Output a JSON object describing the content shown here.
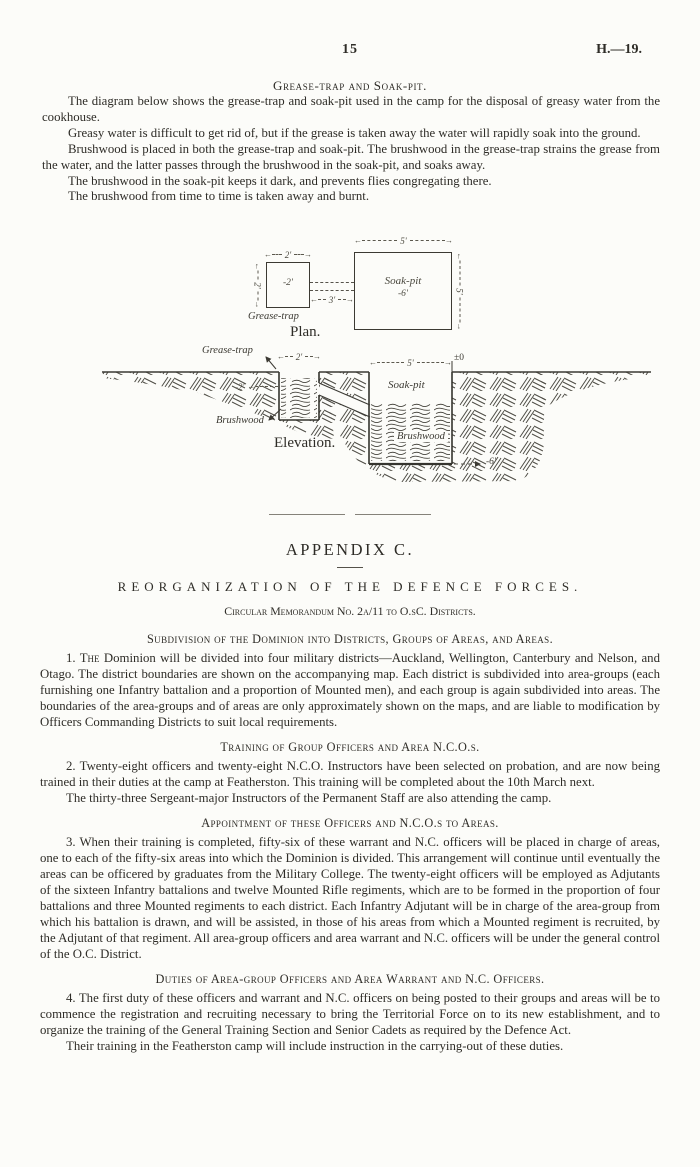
{
  "page": {
    "number": "15",
    "reference": "H.—19."
  },
  "grease_section": {
    "heading": "Grease-trap and Soak-pit.",
    "paragraphs": [
      "The diagram below shows the grease-trap and soak-pit used in the camp for the disposal of greasy water from the cookhouse.",
      "Greasy water is difficult to get rid of, but if the grease is taken away the water will rapidly soak into the ground.",
      "Brushwood is placed in both the grease-trap and soak-pit. The brushwood in the grease-trap strains the grease from the water, and the latter passes through the brushwood in the soak-pit, and soaks away.",
      "The brushwood in the soak-pit keeps it dark, and prevents flies congregating there.",
      "The brushwood from time to time is taken away and burnt."
    ]
  },
  "diagram": {
    "plan": {
      "caption": "Plan.",
      "grease_trap_label": "Grease-trap",
      "grease_trap_width": "2'",
      "grease_trap_side": "2'",
      "grease_trap_depth": "-2'",
      "channel_length": "3'",
      "soak_pit_label": "Soak-pit",
      "soak_pit_width": "5'",
      "soak_pit_side": "5'",
      "soak_pit_depth": "-6'"
    },
    "elevation": {
      "caption": "Elevation.",
      "grease_trap_label": "Grease-trap",
      "grease_trap_width": "2'",
      "grease_trap_depth": "-2'",
      "brushwood_label": "Brushwood",
      "soak_pit_label": "Soak-pit",
      "soak_pit_width": "5'",
      "ground_datum": "±0",
      "pit_brushwood_label": "Brushwood",
      "soak_pit_depth": "-6'"
    }
  },
  "appendix": {
    "title": "APPENDIX C.",
    "heading": "REORGANIZATION OF THE DEFENCE FORCES.",
    "memo_line": "Circular Memorandum No. 2a/11 to O.sC. Districts.",
    "sections": [
      {
        "heading": "Subdivision of the Dominion into Districts, Groups of Areas, and Areas.",
        "lead": "1. The",
        "rest": " Dominion will be divided into four military districts—Auckland, Wellington, Canterbury and Nelson, and Otago. The district boundaries are shown on the accompanying map. Each district is subdivided into area-groups (each furnishing one Infantry battalion and a proportion of Mounted men), and each group is again subdivided into areas. The boundaries of the area-groups and of areas are only approximately shown on the maps, and are liable to modification by Officers Commanding Districts to suit local requirements."
      },
      {
        "heading": "Training of Group Officers and Area N.C.O.s.",
        "paragraphs": [
          "2. Twenty-eight officers and twenty-eight N.C.O. Instructors have been selected on probation, and are now being trained in their duties at the camp at Featherston. This training will be completed about the 10th March next.",
          "The thirty-three Sergeant-major Instructors of the Permanent Staff are also attending the camp."
        ]
      },
      {
        "heading": "Appointment of these Officers and N.C.O.s to Areas.",
        "paragraphs": [
          "3. When their training is completed, fifty-six of these warrant and N.C. officers will be placed in charge of areas, one to each of the fifty-six areas into which the Dominion is divided. This arrangement will continue until eventually the areas can be officered by graduates from the Military College. The twenty-eight officers will be employed as Adjutants of the sixteen Infantry battalions and twelve Mounted Rifle regiments, which are to be formed in the proportion of four battalions and three Mounted regiments to each district. Each Infantry Adjutant will be in charge of the area-group from which his battalion is drawn, and will be assisted, in those of his areas from which a Mounted regiment is recruited, by the Adjutant of that regiment. All area-group officers and area warrant and N.C. officers will be under the general control of the O.C. District."
        ]
      },
      {
        "heading": "Duties of Area-group Officers and Area Warrant and N.C. Officers.",
        "paragraphs": [
          "4. The first duty of these officers and warrant and N.C. officers on being posted to their groups and areas will be to commence the registration and recruiting necessary to bring the Territorial Force on to its new establishment, and to organize the training of the General Training Section and Senior Cadets as required by the Defence Act.",
          "Their training in the Featherston camp will include instruction in the carrying-out of these duties."
        ]
      }
    ]
  }
}
